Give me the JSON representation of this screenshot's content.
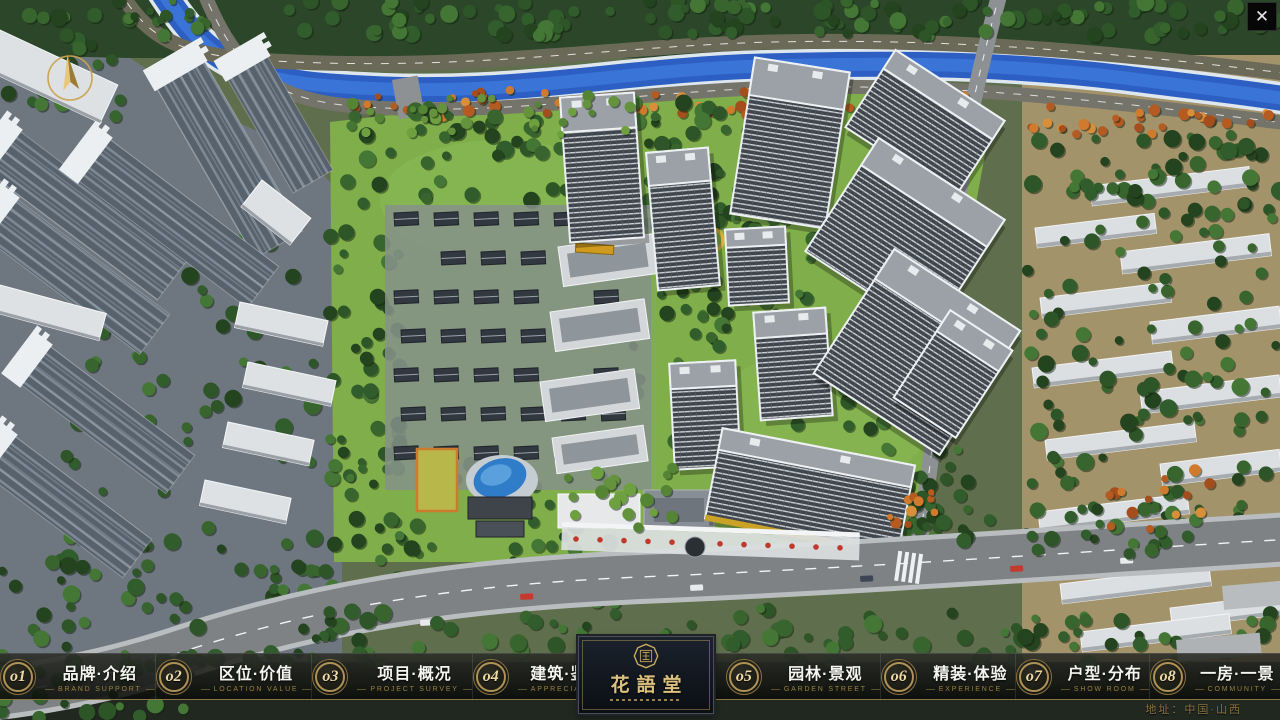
{
  "nav": {
    "items": [
      {
        "num": "o1",
        "label": "品牌·介绍",
        "sub": "BRAND SUPPORT"
      },
      {
        "num": "o2",
        "label": "区位·价值",
        "sub": "LOCATION VALUE"
      },
      {
        "num": "o3",
        "label": "项目·概况",
        "sub": "PROJECT SURVEY"
      },
      {
        "num": "o4",
        "label": "建筑·鉴赏",
        "sub": "APPRECIATION"
      },
      {
        "num": "o5",
        "label": "园林·景观",
        "sub": "GARDEN STREET"
      },
      {
        "num": "o6",
        "label": "精装·体验",
        "sub": "EXPERIENCE"
      },
      {
        "num": "o7",
        "label": "户型·分布",
        "sub": "SHOW ROOM"
      },
      {
        "num": "o8",
        "label": "一房·一景",
        "sub": "COMMUNITY"
      }
    ]
  },
  "logo": {
    "name": "花語堂"
  },
  "footer": {
    "address": "地址：中国·山西"
  },
  "window": {
    "close_label": "✕"
  },
  "colors": {
    "gold": "#bfa05c",
    "river": "#2d5fc2",
    "lawn": "#7fae4a"
  }
}
